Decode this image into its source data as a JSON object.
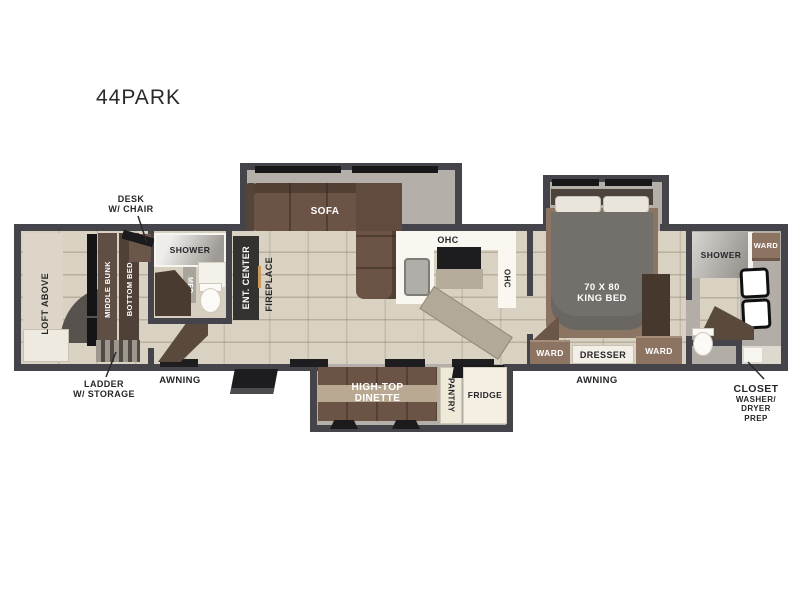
{
  "title": "44PARK",
  "colors": {
    "wall": "#45444a",
    "tile_floor": "#d9d2c3",
    "slide_floor": "#b4b0a9",
    "sofa_brown": "#6b5446",
    "bed_gray": "#73706c",
    "cabinet_brown": "#8d7361",
    "counter_white": "#faf7f0",
    "appliance_black": "#1d1d20"
  },
  "labels": {
    "desk1": "DESK",
    "desk2": "W/ CHAIR",
    "loft": "LOFT ABOVE",
    "middle_bunk": "MIDDLE BUNK",
    "bottom_bed": "BOTTOM BED",
    "ladder1": "LADDER",
    "ladder2": "W/ STORAGE",
    "shower_front": "SHOWER",
    "med": "MED",
    "ent_center": "ENT. CENTER",
    "fireplace": "FIREPLACE",
    "sofa": "SOFA",
    "ohc_top": "OHC",
    "ohc_side": "OHC",
    "awning_left": "AWNING",
    "awning_right": "AWNING",
    "dinette1": "HIGH-TOP",
    "dinette2": "DINETTE",
    "pantry": "PANTRY",
    "fridge": "FRIDGE",
    "bed1": "70 X 80",
    "bed2": "KING BED",
    "ward_bedroom_left": "WARD",
    "dresser": "DRESSER",
    "ward_bedroom_right": "WARD",
    "shower_rear": "SHOWER",
    "ward_rear": "WARD",
    "closet1": "CLOSET",
    "closet2": "WASHER/",
    "closet3": "DRYER",
    "closet4": "PREP"
  }
}
